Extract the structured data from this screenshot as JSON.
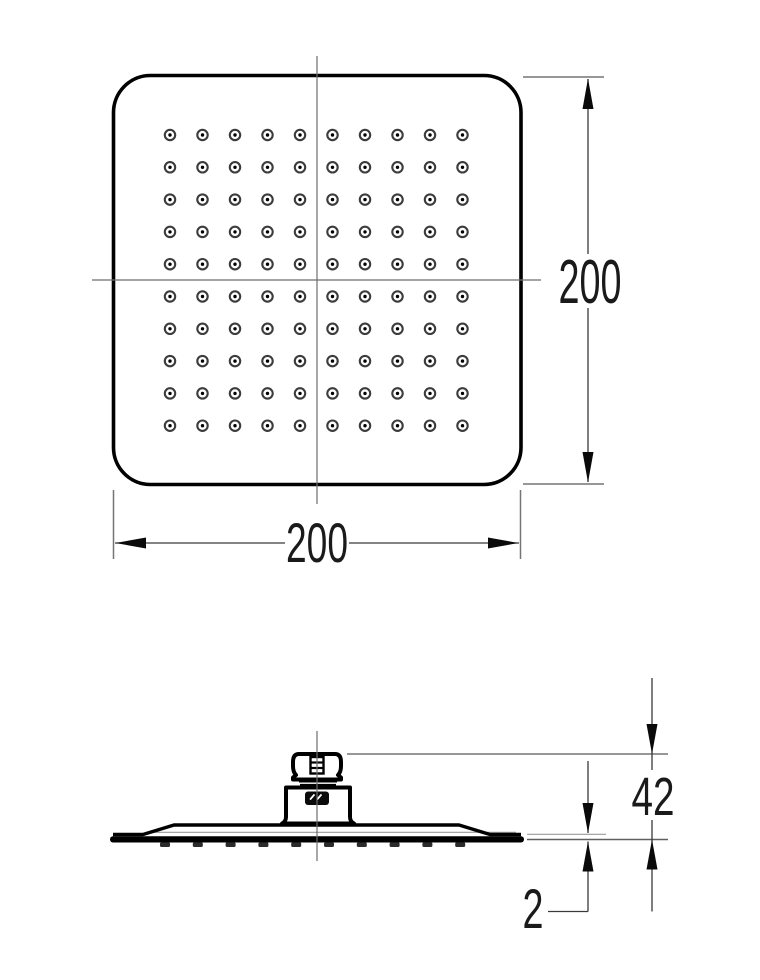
{
  "drawing": {
    "type": "technical-dimension-drawing",
    "subject": "square rain shower head, top view and side view",
    "units": "mm",
    "dimensions": {
      "width": "200",
      "height": "200",
      "head_height": "42",
      "plate_thickness": "2"
    },
    "colors": {
      "outline": "#000000",
      "dimension_line": "#3a3a3a",
      "extension_line": "#757575",
      "extension_line_light": "#9a9a9a",
      "centerline": "#6e6e6e",
      "nozzle_ring": "#3c3c3c",
      "nozzle_dot": "#000000",
      "text": "#1a1a1a",
      "background": "#ffffff"
    },
    "top_view": {
      "nozzle_grid": {
        "rows": 10,
        "cols": 10,
        "x0": 170,
        "y0": 135,
        "dx": 32.5,
        "dy": 32.3,
        "outer_radius": 5.2,
        "ring_width": 2.1,
        "dot_radius": 1.7
      }
    },
    "side_view": {
      "outlet_strip": {
        "count": 10,
        "x0": 165,
        "y": 842.4,
        "dx": 32.8,
        "width": 10,
        "height": 4.6,
        "color": "#2b2b2b"
      }
    }
  }
}
